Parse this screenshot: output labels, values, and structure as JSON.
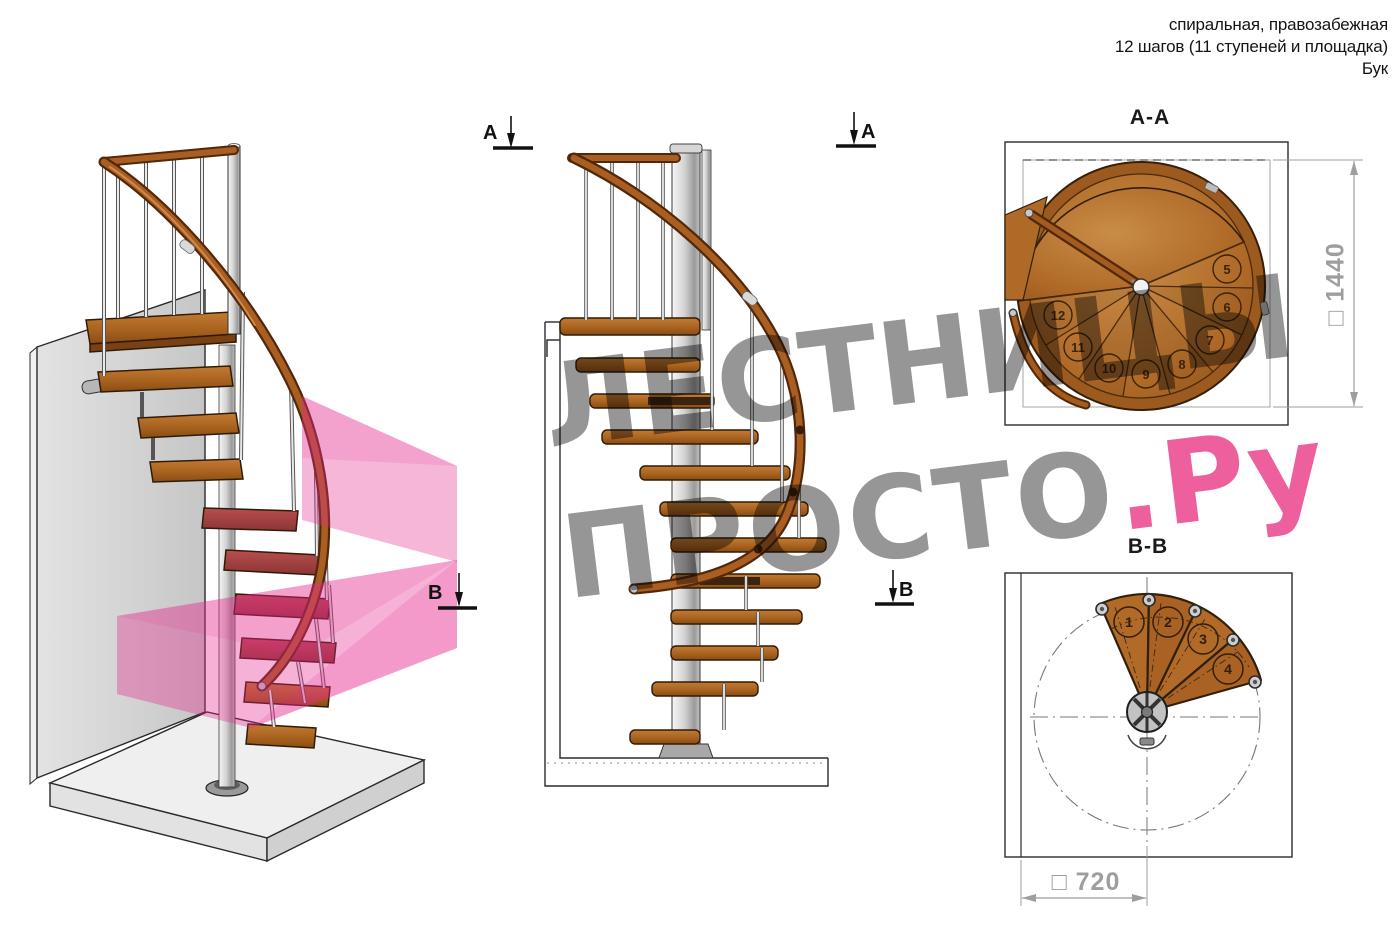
{
  "header": {
    "line1": "спиральная, правозабежная",
    "line2": "12 шагов (11 ступеней и площадка)",
    "line3": "Бук"
  },
  "watermark": {
    "line1": "ЛЕСТНИЦЫ",
    "line2_gray": "ПРОСТО",
    "line2_pink": ".Ру"
  },
  "markers": {
    "section_a": "А",
    "section_b": "В"
  },
  "sections": {
    "aa": {
      "title": "А-А",
      "dimension": "□ 1440",
      "step_numbers": [
        "5",
        "6",
        "7",
        "8",
        "9",
        "10",
        "11",
        "12"
      ]
    },
    "bb": {
      "title": "В-В",
      "dimension": "□ 720",
      "step_numbers": [
        "1",
        "2",
        "3",
        "4"
      ]
    }
  },
  "colors": {
    "wood": "#b06a28",
    "wood_dark": "#53280a",
    "outline": "#2f1b06",
    "metal": "#d9d9d9",
    "pink_overlay": "#e6288c",
    "watermark_gray": "#969696",
    "watermark_pink": "#ee5f9e",
    "dimension_gray": "#9e9e9e"
  }
}
